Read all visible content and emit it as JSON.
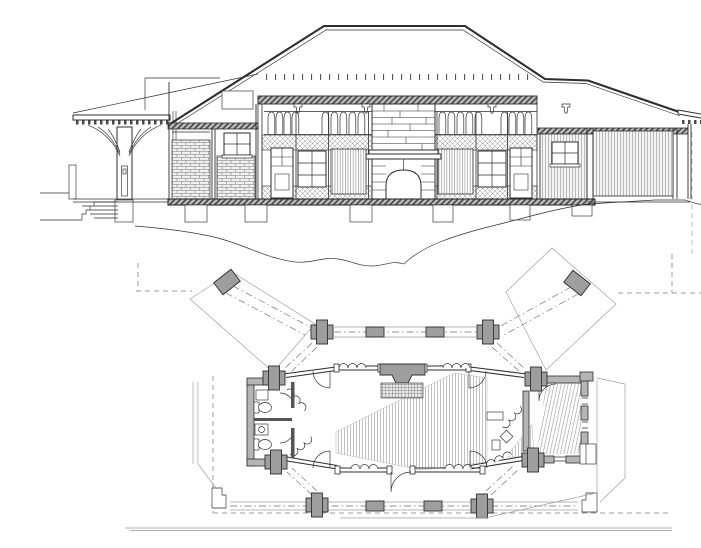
{
  "page": {
    "title": "Architectural drawing: building cross-section above, floor plan with octagonal terrace below",
    "background": "#ffffff"
  },
  "views": {
    "section": {
      "name": "cross-section",
      "parts": [
        "hipped-roof",
        "left-porch-with-curved-brackets",
        "entry-steps",
        "clerestory-arched-windows",
        "lattice-panels",
        "stone-fireplace-and-chimney",
        "brick-service-wing",
        "board-clad-garage-wing",
        "floor-slab",
        "foundation-piers",
        "ground-terrain-line"
      ]
    },
    "plan": {
      "name": "floor-plan",
      "parts": [
        "central-octagonal-hall",
        "fireplace-with-hearth",
        "twin-bathrooms",
        "side-room",
        "octagonal-terrace-railing",
        "corner-piers",
        "diagonal-walkways",
        "rotated-square-piers",
        "door-swings",
        "folding-doors",
        "roof-overhang-dashed-line"
      ]
    }
  },
  "palette": {
    "paper": "#ffffff",
    "ink": "#2e2e2e",
    "line-mid": "#6f6f6f",
    "line-light": "#9b9b9b",
    "pier-fill": "#9e9e9e",
    "wall-fill": "#b5b5b5",
    "band-fill": "#bdbdbd"
  }
}
